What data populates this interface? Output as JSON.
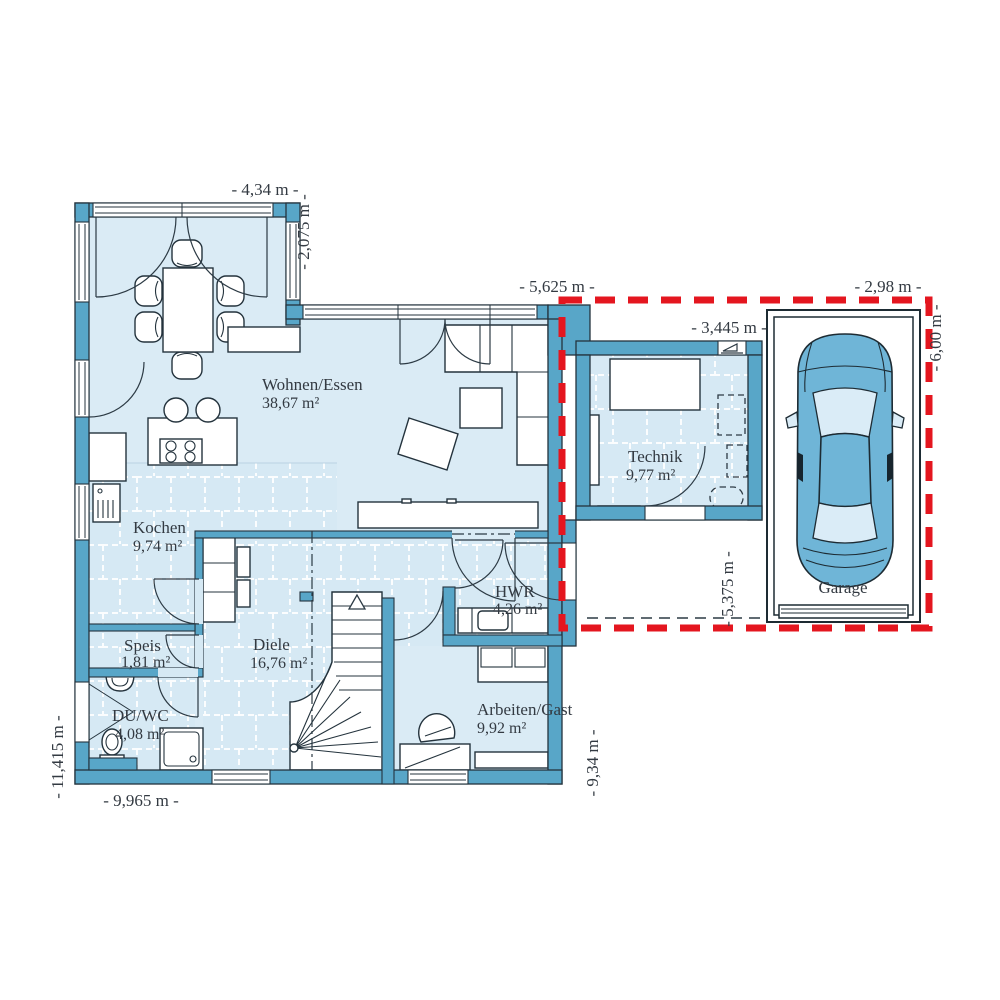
{
  "plan": {
    "title": "floor-plan-ground-floor",
    "rooms": {
      "wohnen": {
        "name": "Wohnen/Essen",
        "area": "38,67 m²"
      },
      "kochen": {
        "name": "Kochen",
        "area": "9,74 m²"
      },
      "speis": {
        "name": "Speis",
        "area": "1,81 m²"
      },
      "duwc": {
        "name": "DU/WC",
        "area": "4,08 m²"
      },
      "diele": {
        "name": "Diele",
        "area": "16,76 m²"
      },
      "hwr": {
        "name": "HWR",
        "area": "4,26 m²"
      },
      "arbeiten": {
        "name": "Arbeiten/Gast",
        "area": "9,92 m²"
      },
      "technik": {
        "name": "Technik",
        "area": "9,77 m²"
      },
      "garage": {
        "name": "Garage"
      }
    },
    "dims": {
      "d434": "- 4,34 m -",
      "d2075": "- 2,075 m -",
      "d5625": "- 5,625 m -",
      "d298": "- 2,98 m -",
      "d3445": "- 3,445 m -",
      "d600": "- 6,00 m -",
      "d5375": "- 5,375 m -",
      "d934": "- 9,34 m -",
      "d9965": "- 9,965 m -",
      "d11415": "- 11,415 m -"
    },
    "icons": {
      "entrance_arrow": "slope-arrow",
      "stair_direction_arrow": "up-arrow"
    },
    "colors": {
      "wall": "#58A6C8",
      "floor": "#DAEBF5",
      "tile": "#D6E9F4",
      "outline": "#24333D",
      "red": "#E4161F",
      "carbody": "#6FB5D7",
      "carglass": "#DAECF7",
      "text": "#333A42"
    }
  }
}
